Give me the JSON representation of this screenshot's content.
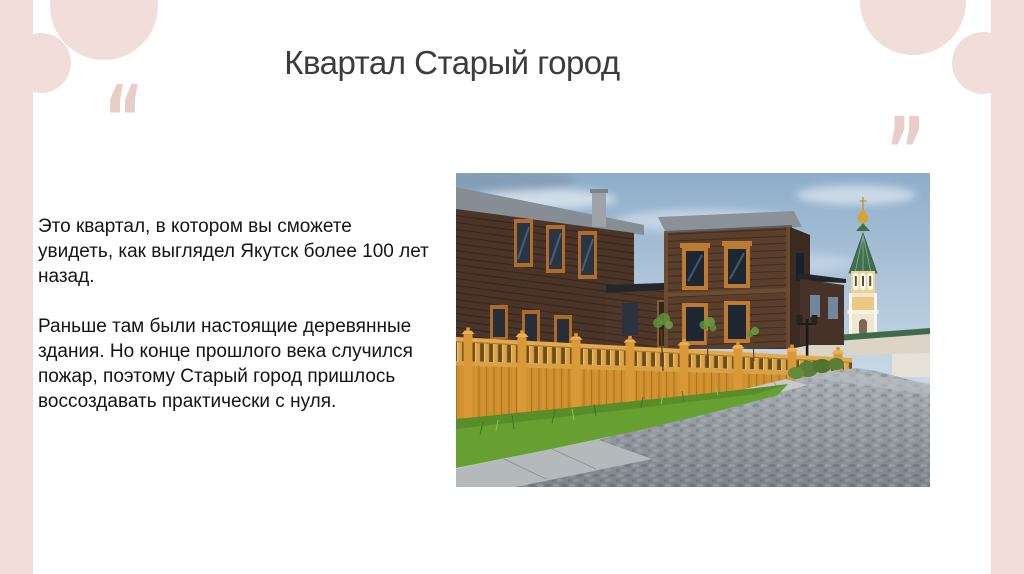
{
  "slide": {
    "title": "Квартал Старый город",
    "quotes": {
      "open": "“",
      "close": "”"
    },
    "paragraphs": {
      "p1": "Это квартал, в котором вы сможете\nувидеть, как выглядел Якутск более 100 лет\nназад.",
      "p2": "Раньше там были настоящие деревянные\nздания. Но конце прошлого века случился\nпожар, поэтому Старый город пришлось\nвоссоздавать практически с нуля."
    },
    "colors": {
      "accent_pink": "#f1dedb",
      "quote_pink": "#e8cdc9",
      "title_text": "#3c3c3c",
      "body_text": "#141414",
      "background": "#ffffff"
    }
  }
}
